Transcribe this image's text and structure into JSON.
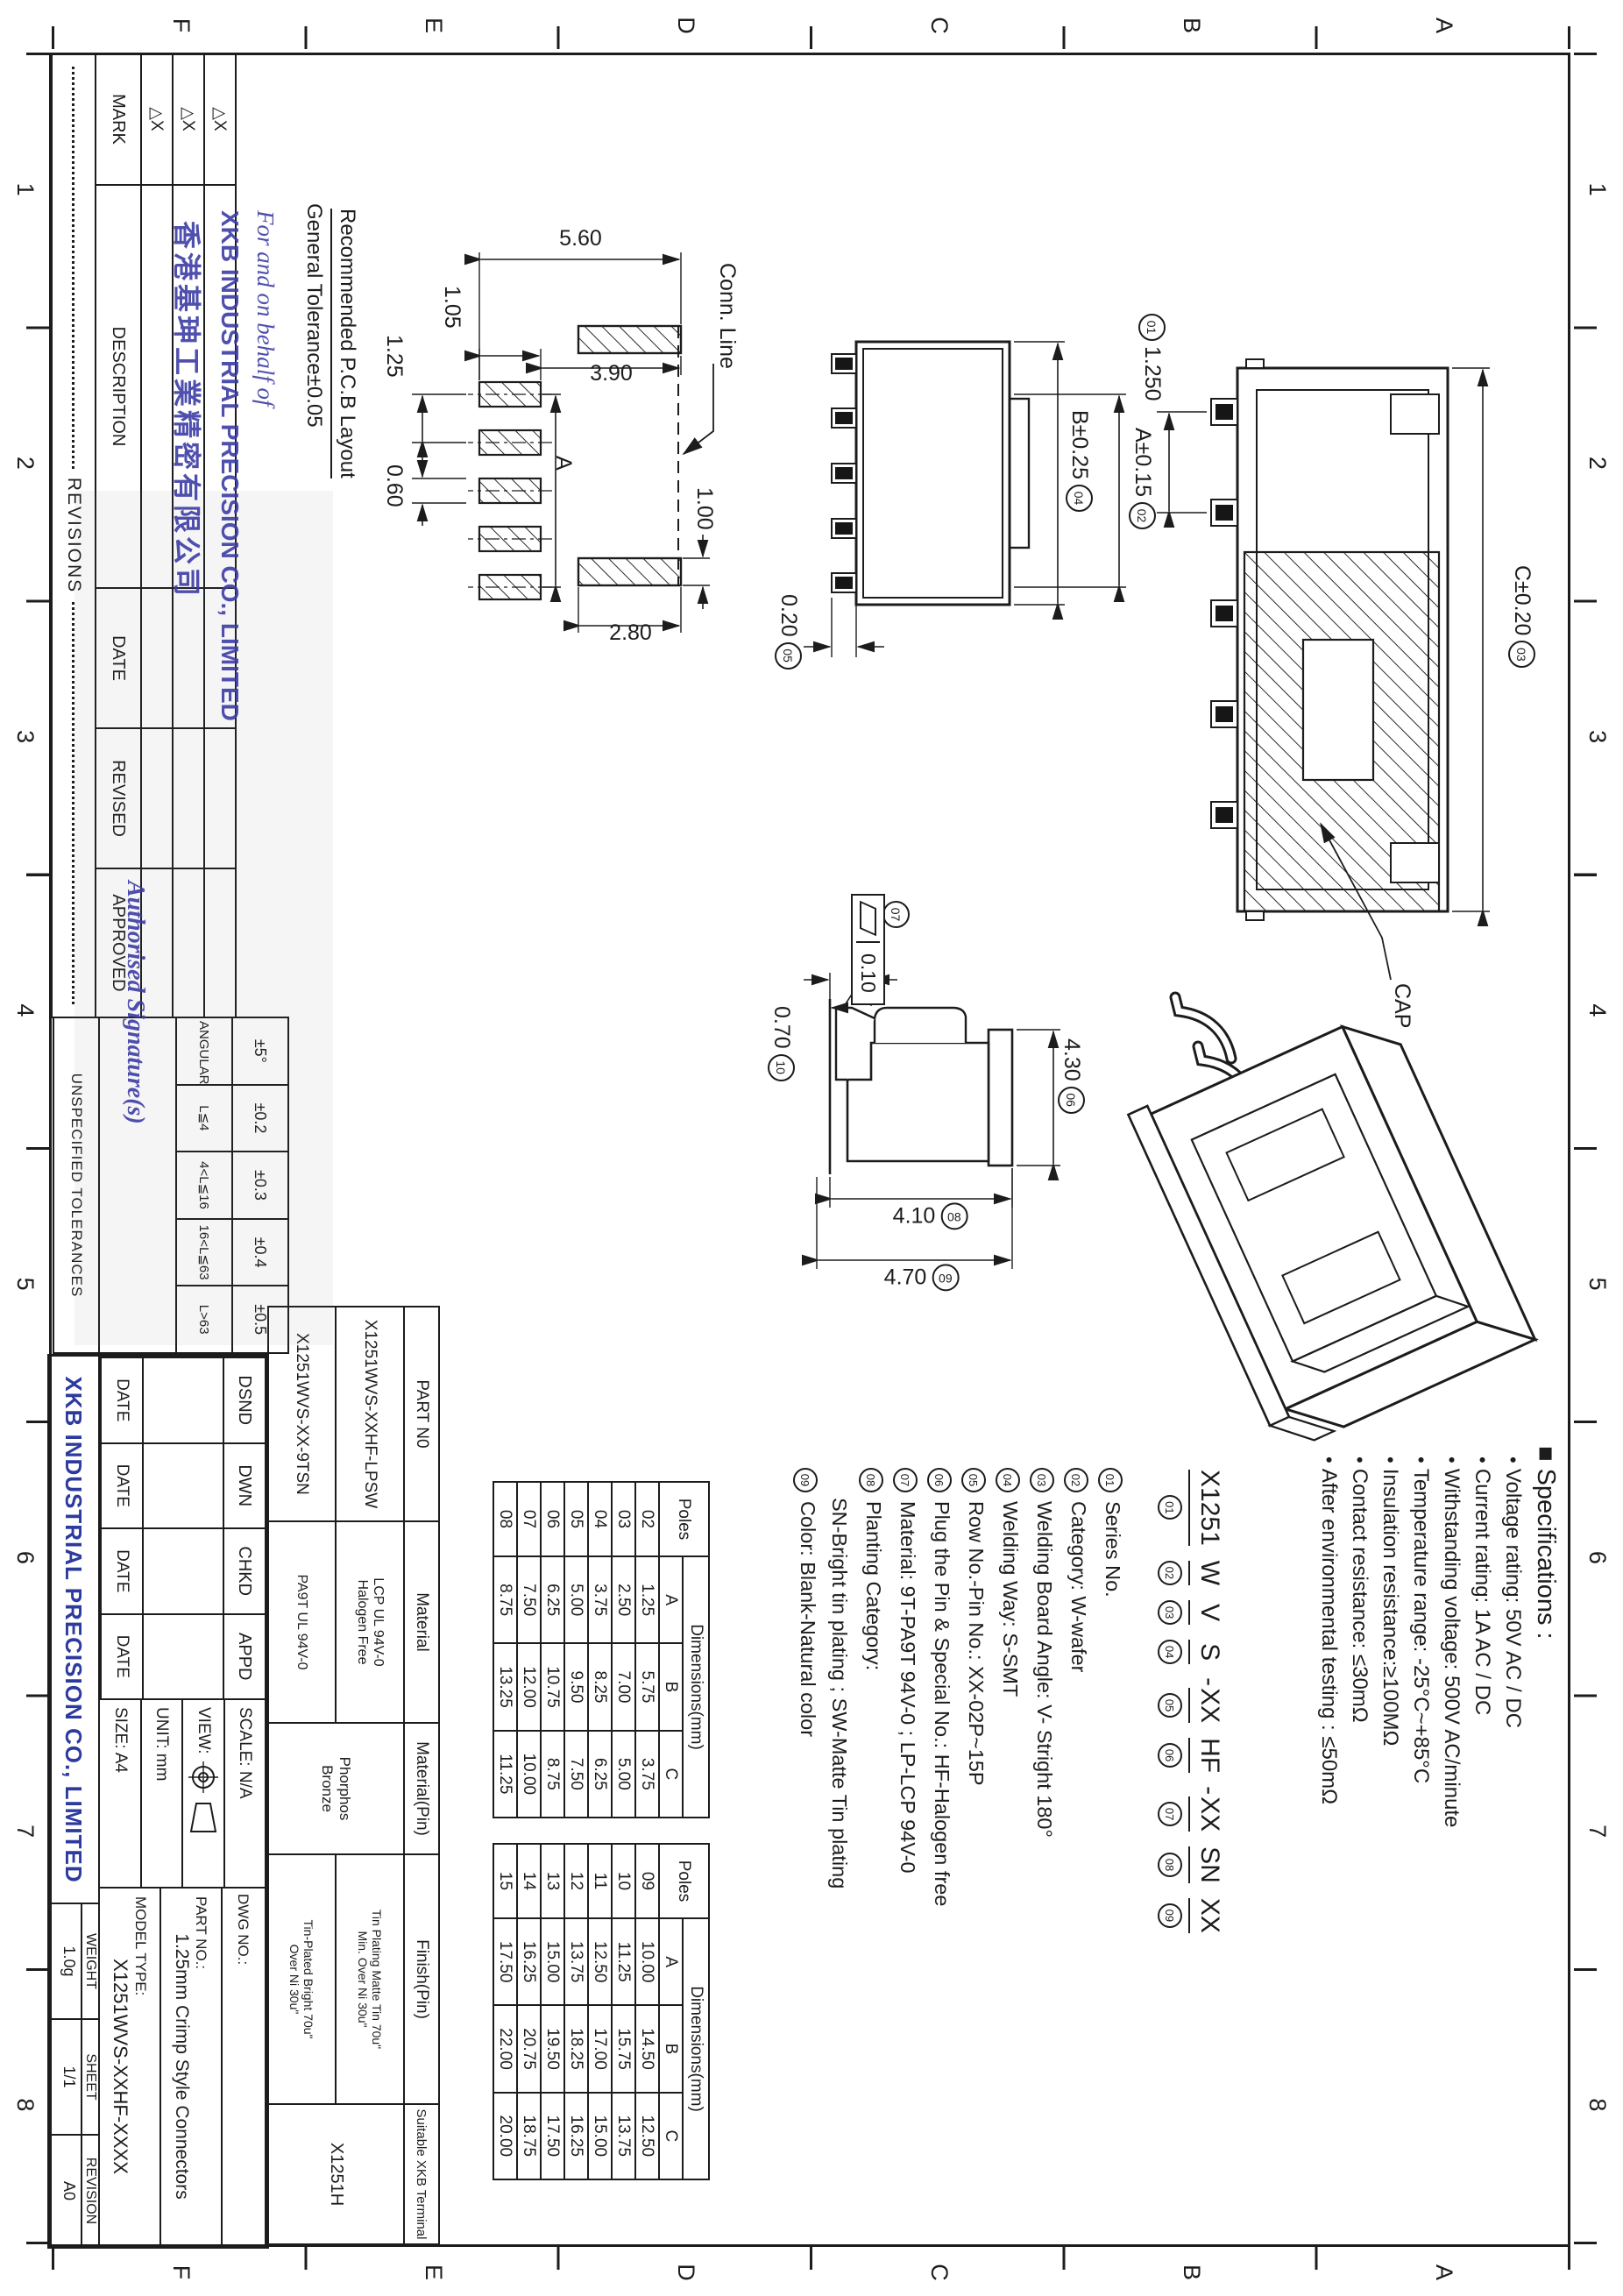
{
  "zones": {
    "numbers": [
      "1",
      "2",
      "3",
      "4",
      "5",
      "6",
      "7",
      "8"
    ],
    "letters": [
      "A",
      "B",
      "C",
      "D",
      "E",
      "F"
    ]
  },
  "stamp": {
    "line1": "For and on behalf of",
    "line2": "XKB INDUSTRIAL PRECISION CO., LIMITED",
    "line3": "香港基珅工業精密有限公司",
    "line4": "Authorised Signature(s)"
  },
  "revision_table": {
    "title": "REVISIONS",
    "mark_symbol": "△X",
    "headers": {
      "mark": "MARK",
      "description": "DESCRIPTION",
      "date": "DATE",
      "revised": "REVISED",
      "approved": "APPROVED"
    }
  },
  "tolerance_table": {
    "title": "UNSPECIFIED TOLERANCES",
    "values": [
      "±5°",
      "±0.2",
      "±0.3",
      "±0.4",
      "±0.5"
    ],
    "labels": [
      "ANGULAR",
      "L≦4",
      "4<L≦16",
      "16<L≦63",
      "L>63"
    ]
  },
  "sig_block": {
    "cols": [
      "DSND",
      "DWN",
      "CHKD",
      "APPD"
    ],
    "date_label": "DATE"
  },
  "info_block": {
    "scale": "SCALE: N/A",
    "view_label": "VIEW:",
    "unit": "UNIT:  mm",
    "size": "SIZE:  A4",
    "dwg_no_label": "DWG NO.:",
    "part_no_label": "PART NO.:",
    "part_title": "1.25mm Crimp Style Connectors",
    "model_label": "MODEL TYPE:",
    "model_value": "X1251WVS-XXHF-XXXX",
    "company": "XKB INDUSTRIAL PRECISION CO., LIMITED",
    "weight_label": "WEIGHT",
    "weight_value": "1.0g",
    "sheet_label": "SHEET",
    "sheet_value": "1/1",
    "revision_label": "REVISION",
    "revision_value": "A0"
  },
  "part_table": {
    "h_part": "PART N0",
    "h_material": "Material",
    "h_material_pin": "Material(Pin)",
    "h_finish_pin": "Finish(Pin)",
    "h_terminal": "Suitable XKB Terminal",
    "row1_part": "X1251WVS-XXHF-LPSW",
    "row1_material_l1": "LCP  UL 94V-0",
    "row1_material_l2": "Halogen  Free",
    "row2_part": "X1251WVS-XX-9TSN",
    "row2_material": "PA9T  UL 94V-0",
    "material_pin_l1": "Phorphos",
    "material_pin_l2": "Bronze",
    "row1_finish_l1": "Tin Plating Matte Tin 70u\"",
    "row1_finish_l2": "Min. Over Ni 30u\"",
    "row2_finish_l1": "Tin-Plated Bright 70u\"",
    "row2_finish_l2": "Over Ni 30u\"",
    "terminal_value": "X1251H"
  },
  "specs": {
    "title": "■ Specifications :",
    "items": [
      "Voltage rating: 50V AC / DC",
      "Current rating: 1A  AC / DC",
      "Withstanding voltage: 500V AC/minute",
      "Temperature range: -25°C~+85°C",
      "Insulation resistance:≥100MΩ",
      "Contact resistance: ≤30mΩ",
      "After environmental testing :  ≤50mΩ"
    ]
  },
  "order_code": {
    "segments": [
      {
        "t": "X1251",
        "n": "01"
      },
      {
        "t": "W",
        "n": "02"
      },
      {
        "t": "V",
        "n": "03"
      },
      {
        "t": "S",
        "n": "04"
      },
      {
        "sep": "-",
        "t": "XX",
        "n": "05"
      },
      {
        "t": "HF",
        "n": "06"
      },
      {
        "sep": "-",
        "t": "XX",
        "n": "07"
      },
      {
        "t": "SN",
        "n": "08"
      },
      {
        "t": "XX",
        "n": "09"
      }
    ]
  },
  "notes": {
    "items": [
      {
        "n": "01",
        "t": "Series No."
      },
      {
        "n": "02",
        "t": "Category:  W-wafer"
      },
      {
        "n": "03",
        "t": "Welding Board Angle: V- Stright 180°"
      },
      {
        "n": "04",
        "t": "Welding Way:  S-SMT"
      },
      {
        "n": "05",
        "t": "Row No.-Pin No.: XX-02P~15P"
      },
      {
        "n": "06",
        "t": "Plug the Pin & Special No.: HF-Halogen free"
      },
      {
        "n": "07",
        "t": "Material:  9T-PA9T  94V-0 ; LP-LCP  94V-0"
      },
      {
        "n": "08",
        "t": "Planting Category:"
      },
      {
        "n": "",
        "t": "SN-Bright tin plating ;  SW-Matte Tin plating"
      },
      {
        "n": "09",
        "t": "Color:  Blank-Natural color"
      }
    ]
  },
  "dim_tables": {
    "poles_header": "Poles",
    "dim_header": "Dimensions(mm)",
    "cols": [
      "A",
      "B",
      "C"
    ],
    "t1_rows": [
      [
        "02",
        "1.25",
        "5.75",
        "3.75"
      ],
      [
        "03",
        "2.50",
        "7.00",
        "5.00"
      ],
      [
        "04",
        "3.75",
        "8.25",
        "6.25"
      ],
      [
        "05",
        "5.00",
        "9.50",
        "7.50"
      ],
      [
        "06",
        "6.25",
        "10.75",
        "8.75"
      ],
      [
        "07",
        "7.50",
        "12.00",
        "10.00"
      ],
      [
        "08",
        "8.75",
        "13.25",
        "11.25"
      ]
    ],
    "t2_rows": [
      [
        "09",
        "10.00",
        "14.50",
        "12.50"
      ],
      [
        "10",
        "11.25",
        "15.75",
        "13.75"
      ],
      [
        "11",
        "12.50",
        "17.00",
        "15.00"
      ],
      [
        "12",
        "13.75",
        "18.25",
        "16.25"
      ],
      [
        "13",
        "15.00",
        "19.50",
        "17.50"
      ],
      [
        "14",
        "16.25",
        "20.75",
        "18.75"
      ],
      [
        "15",
        "17.50",
        "22.00",
        "20.00"
      ]
    ]
  },
  "drawings": {
    "pcb": {
      "caption1": "Recommended P.C.B Layout",
      "caption2": "General Tolerance±0.05",
      "conn": "Conn. Line",
      "d560": "5.60",
      "d390": "3.90",
      "d105": "1.05",
      "d125": "1.25",
      "dA": "A",
      "d060": "0.60",
      "d100": "1.00",
      "d280": "2.80"
    },
    "front": {
      "pitch": "1.250",
      "pitch_n": "01",
      "c": "C±0.20",
      "c_n": "03",
      "cap": "CAP"
    },
    "top": {
      "a": "A±0.15",
      "a_n": "02",
      "b": "B±0.25",
      "b_n": "04",
      "t": "0.20",
      "t_n": "05"
    },
    "side": {
      "w": "4.30",
      "w_n": "06",
      "fcf_n": "07",
      "fcf_val": "0.10",
      "h1": "4.10",
      "h1_n": "08",
      "h2": "4.70",
      "h2_n": "09",
      "f": "0.70",
      "f_n": "10"
    }
  }
}
